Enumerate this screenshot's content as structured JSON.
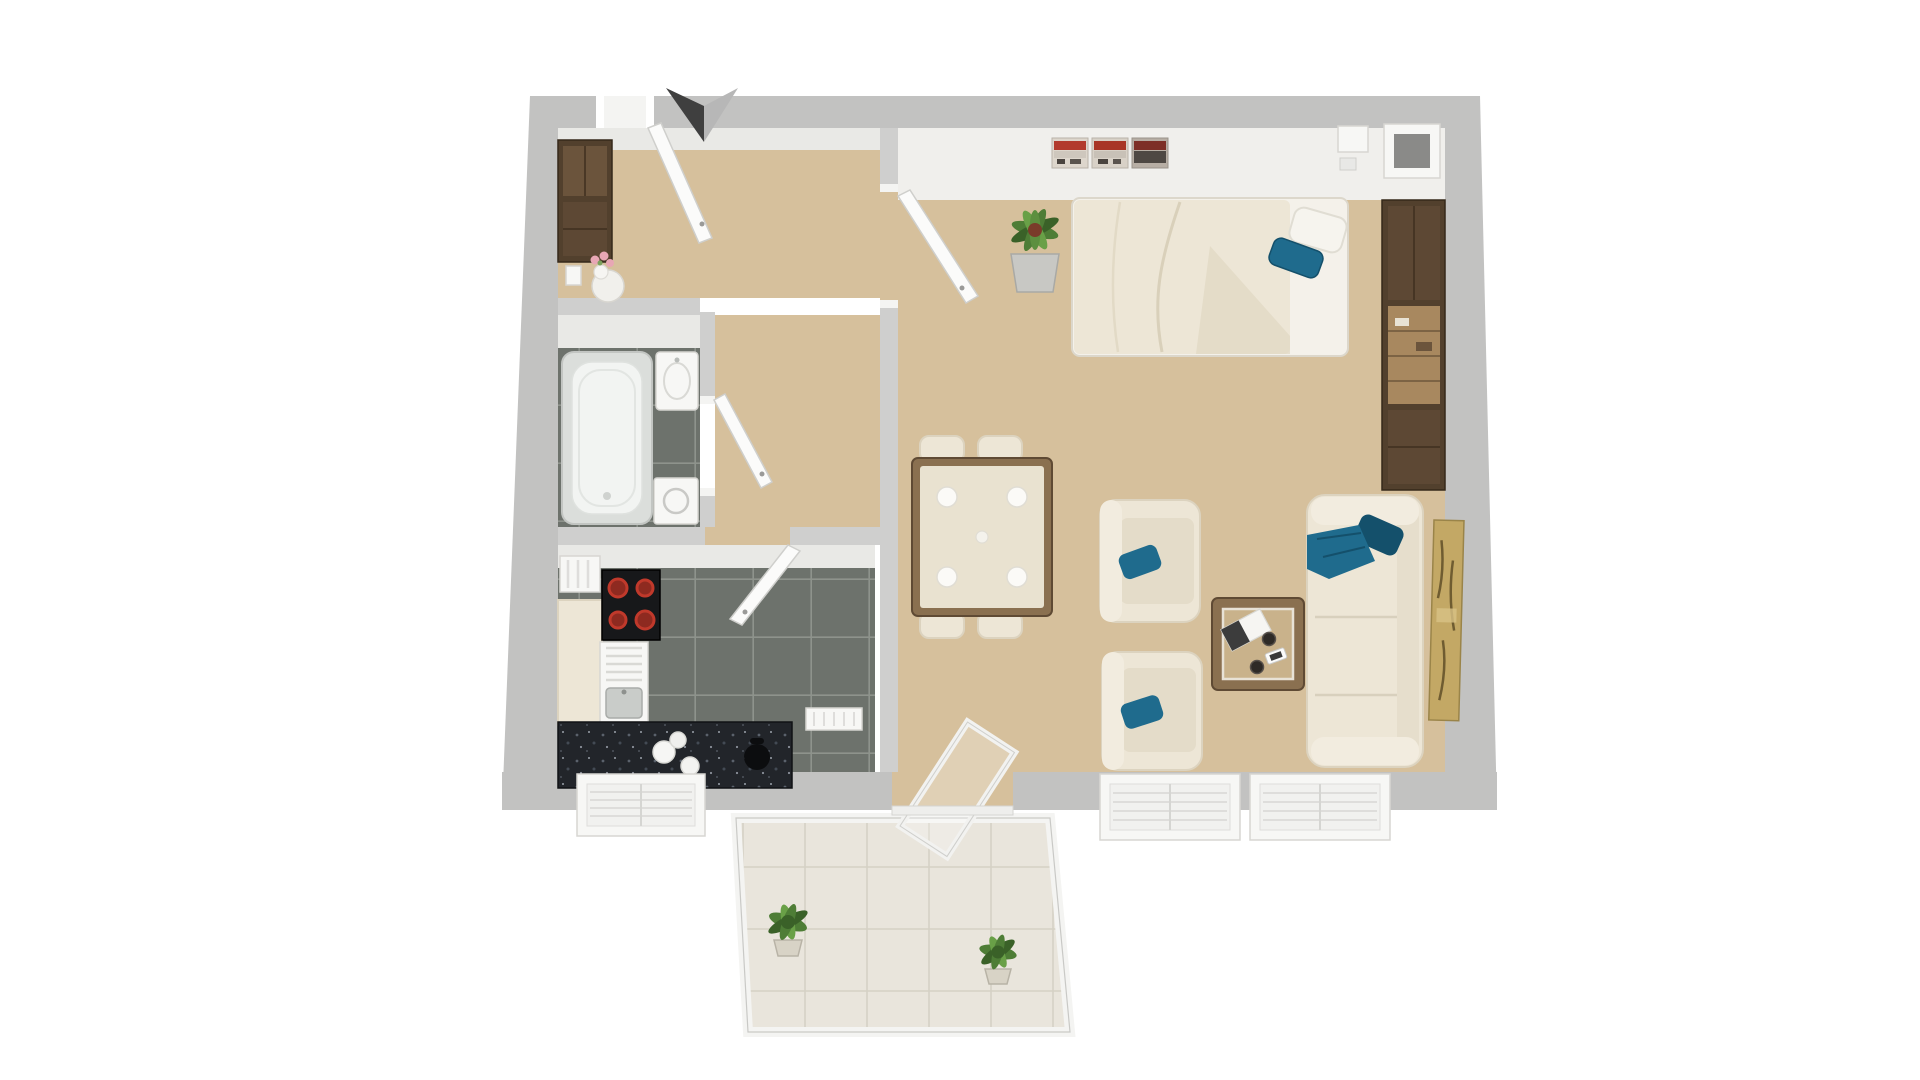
{
  "meta": {
    "kind": "3d-floor-plan-rendering",
    "background": "#ffffff"
  },
  "colors": {
    "wall": "#c2c2c1",
    "wallIn": "#cfcfce",
    "face": "#e9e9e6",
    "faceL": "#f0efec",
    "tan": "#d6c09c",
    "tanDark": "#c9b28b",
    "tile": "#6d726c",
    "grout": "#8e938c",
    "cream": "#ede6d6",
    "creamDark": "#dcd3bf",
    "white": "#f7f7f5",
    "teal": "#1f6b8d",
    "tealDark": "#14506b",
    "woodDark": "#52402d",
    "wood": "#8a7050",
    "woodLight": "#a8885f",
    "granite": "#22252a",
    "red": "#c0392b",
    "green": "#4e7d36",
    "greenD": "#3a6128",
    "gold": "#c3a865",
    "pink": "#e8a7b5",
    "metal": "#c9ccc9",
    "balTile": "#e9e5dc",
    "balGrout": "#d5d1c5",
    "arrowDark": "#3f3f3f",
    "arrowLight": "#b7b7b7"
  },
  "floorplan": {
    "style": "top-down 3d render, unfurnished text-free",
    "rooms": [
      {
        "name": "entry-hall",
        "floor": "beige",
        "items": [
          "entry-wardrobe",
          "side-table-with-flower-vase",
          "front-door-open"
        ]
      },
      {
        "name": "bathroom",
        "floor": "dark-gray-tile",
        "items": [
          "bathtub",
          "washbasin",
          "washing-machine",
          "bathroom-door-open"
        ]
      },
      {
        "name": "kitchen",
        "floor": "dark-gray-tile",
        "items": [
          "radiator",
          "tall-cream-cabinet",
          "cooktop-four-red-burners",
          "sink-with-drainer",
          "black-stone-counter",
          "white-plates",
          "kettle",
          "kitchen-window",
          "small-radiator",
          "kitchen-door-open"
        ]
      },
      {
        "name": "living-bedroom",
        "floor": "beige",
        "items": [
          "double-bed-with-duvet",
          "white-pillow",
          "teal-pillow",
          "wall-triptych-art",
          "potted-plant",
          "wardrobe-shelving-unit",
          "wall-boxes",
          "dining-table",
          "four-chairs",
          "table-plates",
          "armchair-1",
          "armchair-2",
          "coffee-table",
          "magazine",
          "two-cups",
          "smartphone",
          "sofa",
          "teal-sofa-pillow",
          "teal-throw",
          "leaning-gold-artwork",
          "window-1",
          "window-2",
          "balcony-glass-door-open"
        ]
      },
      {
        "name": "balcony",
        "floor": "light-tile",
        "items": [
          "glass-railing",
          "balcony-plant-1",
          "balcony-plant-2"
        ]
      }
    ],
    "markers": [
      {
        "name": "entrance-arrow",
        "desc": "two-tone chevron above entry door"
      }
    ]
  }
}
